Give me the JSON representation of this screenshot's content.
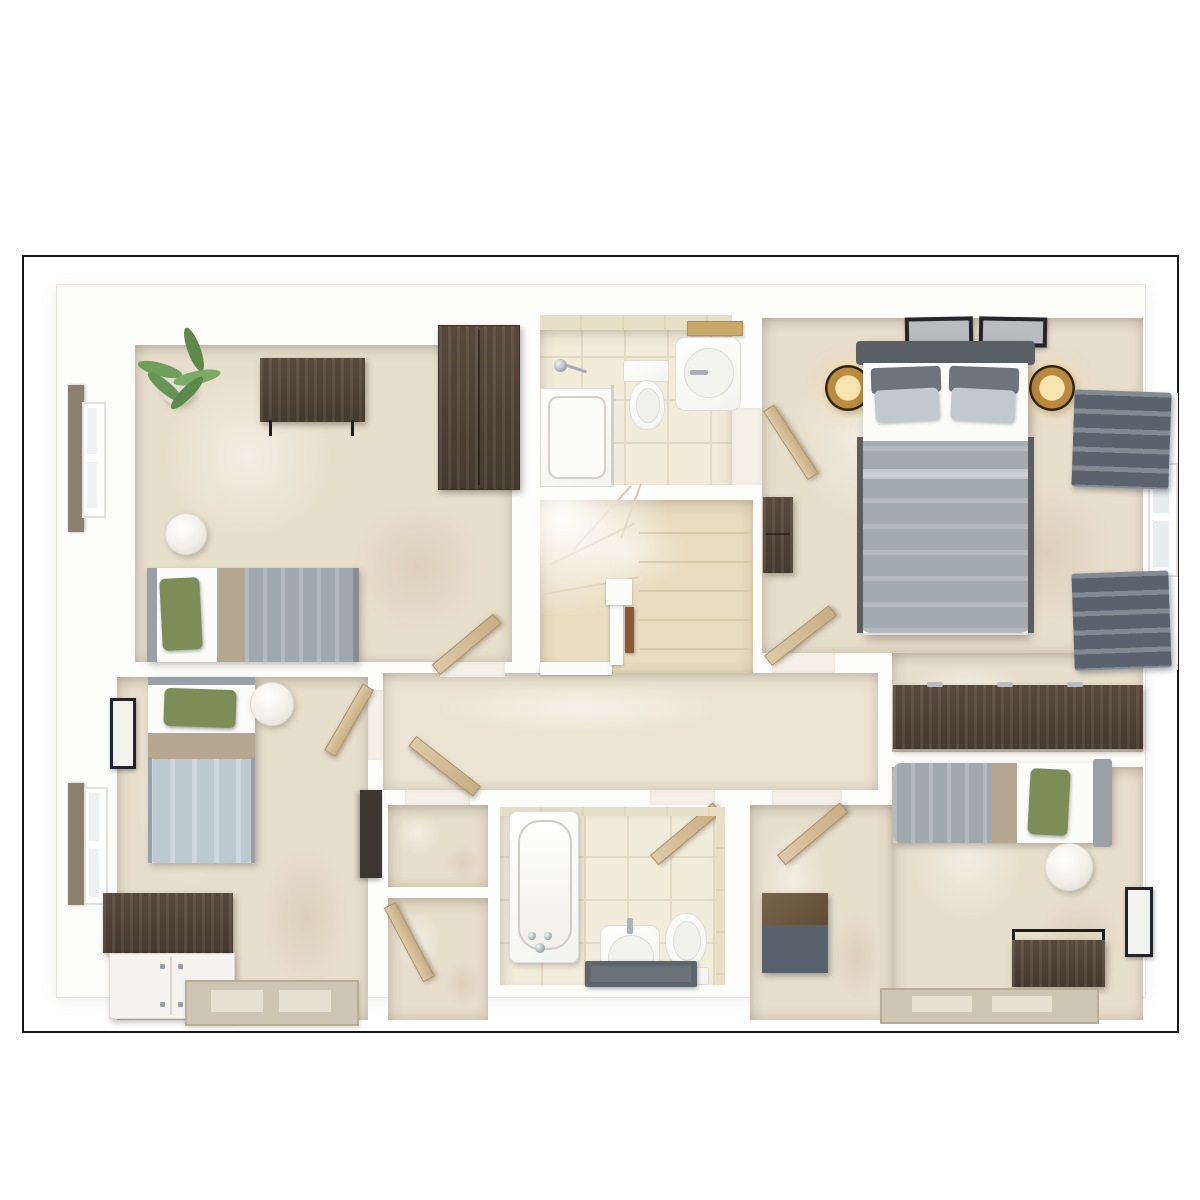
{
  "meta": {
    "view": "3d-dollhouse-floorplan-top-down",
    "floor_label": "",
    "visible_text": "none"
  },
  "colors": {
    "frame": "#161616",
    "wall": "#fdfdfc",
    "floor_carpet": "#e8decc",
    "floor_carpet_light": "#ece3d2",
    "floor_tile": "#f2ecdb",
    "tile_grid": "#e2dac3",
    "tileband": "#e7dfc6",
    "tread": "#d9c9ab",
    "wood_dark": "#4a3e33",
    "wood_mid": "#5d4f41",
    "wood_door": "#dcc9a6",
    "duvet_gray": "#a9b1b9",
    "duvet_blue": "#c5d1da",
    "sheet_white": "#fbfbfa",
    "runner_taupe": "#b5a690",
    "pillow_green": "#7e8c57",
    "headboard_gray": "#9aa0a6",
    "headboard_dark": "#5a5f63",
    "curtain": "#6e7783",
    "brass": "#b98a3f",
    "brass_glow": "#f7e4af",
    "plant_green": "#6f9e5a",
    "mat_dark": "#5f646a",
    "rug_taupe": "#cfc5b4"
  },
  "rooms": [
    {
      "id": "bedroom-2",
      "position": "top-left",
      "furniture": [
        "single-bed-green-pillow-gray-duvet",
        "desk-dark-wood-metal-frame",
        "tall-wardrobe-dark-wood",
        "potted-palm-plant",
        "round-stool",
        "window-with-roman-blind"
      ]
    },
    {
      "id": "ensuite-shower-room",
      "position": "top-middle",
      "furniture": [
        "shower-enclosure-glass-screen",
        "toilet",
        "washbasin",
        "wood-shelf"
      ]
    },
    {
      "id": "master-bedroom",
      "position": "top-right",
      "furniture": [
        "double-bed-gray-duvet",
        "two-picture-frames",
        "two-brass-table-lamps",
        "chest-of-drawers",
        "long-desk-dark-wood",
        "window-two-gray-roman-blinds",
        "entry-door",
        "ensuite-door"
      ]
    },
    {
      "id": "stairwell",
      "position": "center",
      "furniture": [
        "winder-staircase",
        "white-balustrade",
        "newel-post",
        "wood-handrail"
      ]
    },
    {
      "id": "landing-corridor",
      "position": "center",
      "furniture": [
        "carpet"
      ]
    },
    {
      "id": "bedroom-3",
      "position": "bottom-left",
      "furniture": [
        "single-bed-green-pillow-blue-duvet",
        "sideboard-wood-top-white-doors",
        "tall-dark-cabinet",
        "round-pendant-stool",
        "picture-frame",
        "window-with-roman-blind",
        "rug"
      ]
    },
    {
      "id": "storage-cupboards",
      "position": "bottom-center-left",
      "furniture": [
        "upper-cupboard",
        "lower-cupboard",
        "cupboard-door"
      ]
    },
    {
      "id": "bathroom",
      "position": "bottom-middle",
      "furniture": [
        "bathtub",
        "pedestal-washbasin",
        "toilet",
        "dark-bath-mat",
        "tiled-walls"
      ]
    },
    {
      "id": "bedroom-4",
      "position": "bottom-right",
      "furniture": [
        "single-bed-green-pillow-gray-duvet",
        "chest-wood-top-gray-front",
        "desk-metal-frame",
        "round-stool",
        "picture-frame",
        "rug"
      ]
    }
  ]
}
